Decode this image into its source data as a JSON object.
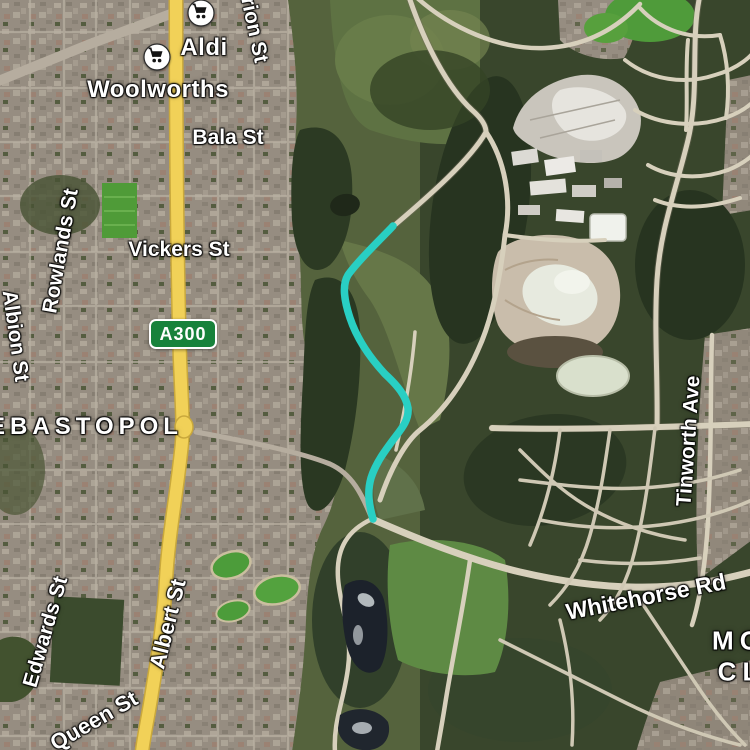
{
  "view": {
    "type": "satellite-map",
    "label_text_color": "#ffffff"
  },
  "locality_labels": {
    "sebastopol": "EBASTOPOL",
    "mount_clear_line1": "MO",
    "mount_clear_line2": "CL"
  },
  "street_labels": {
    "bala": "Bala St",
    "orion_partial": "rion St",
    "vickers": "Vickers St",
    "rowlands": "Rowlands St",
    "albion": "Albion St",
    "edwards": "Edwards St",
    "albert": "Albert St",
    "queen": "Queen St",
    "tinworth": "Tinworth Ave",
    "whitehorse": "Whitehorse Rd"
  },
  "poi_labels": {
    "aldi": "Aldi",
    "woolworths": "Woolworths"
  },
  "poi_icons": {
    "aldi": "shopping-cart-icon",
    "woolworths": "shopping-cart-icon"
  },
  "route_shield": {
    "label": "A300",
    "bg_color": "#17823b",
    "border_color": "#ffffff"
  },
  "route": {
    "color": "#29cfc3"
  },
  "colors": {
    "major_road_yellow": "#f1d158",
    "minor_road_cream": "#d7d0bc",
    "suburb_base": "#968d81",
    "forest_dark": "#2c3a23"
  }
}
